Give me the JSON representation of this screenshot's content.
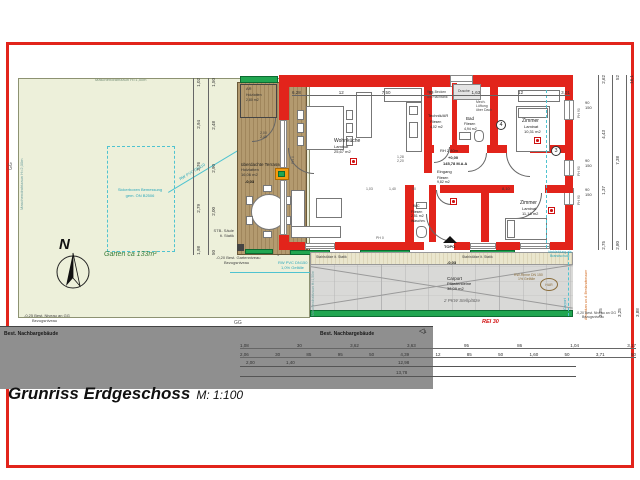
{
  "title": {
    "main": "Grunriss Erdgeschoss",
    "scale": "M: 1:100"
  },
  "compass": {
    "n": "N"
  },
  "garden": {
    "label": "Garten ca 133m²",
    "fence_top": "Maschendrahtzaun H=1,50m",
    "fence_left": "Maschendrahtzaun H=2,00m",
    "gg_left": "GG",
    "gg_bottom": "GG",
    "level1": "-0,25 Best. Niveau an GG",
    "level2": "Bezugsniveau",
    "sicker1": "Sickerboxen Bemessung",
    "sicker2": "gem. ÖN B2506",
    "glevel1": "-0,20 Best. Gartenniveau",
    "glevel2": "Bezugsniveau",
    "shading": "Verschattungselemente",
    "pipe_diag": "RW PVC DN110",
    "pipe1": "RW PVC DN150",
    "pipe2": "1,0% Gefälle"
  },
  "terrace": {
    "name": "überdachte Terrasse",
    "finish": "Holzlatten",
    "area": "16,06 m2",
    "level": "-0,03",
    "stb1": "STB- Säule",
    "stb2": "lt. Statik",
    "door_w": "2,00",
    "door_h": "2,40"
  },
  "ar": {
    "name": "AR",
    "finish": "Holzlatten",
    "area": "2,80 m2"
  },
  "rooms": {
    "wohnkueche": {
      "name": "Wohnküche",
      "finish": "Laminat",
      "area": "25,67 m2"
    },
    "technik": {
      "name": "Technik/AR",
      "finish": "Fliesen",
      "area": "4,02 m2"
    },
    "bad": {
      "name": "Bad",
      "finish": "Fliesen",
      "area": "4,94 m2"
    },
    "zimmer1": {
      "name": "Zimmer",
      "finish": "Laminat",
      "area": "10,31 m2"
    },
    "eingang": {
      "name": "Eingang",
      "finish": "Fliesen",
      "area": "9,82 m2",
      "rh": "RH 2,80m",
      "level": "+0,00",
      "alt": "145,78 M.ü.A"
    },
    "wc": {
      "name": "WC",
      "finish": "Fliesen",
      "area": "2,51 m2"
    },
    "zimmer2": {
      "name": "Zimmer",
      "finish": "Laminat",
      "area": "11,18 m2"
    }
  },
  "notes": {
    "tech1": "Ret.-Becken",
    "tech2": "als Flachtank",
    "dusche": "Dusche",
    "bad1": "Mech.",
    "bad2": "Lüftung",
    "bad3": "über Dach",
    "waschm": "Waschm."
  },
  "tags": {
    "win90": "90",
    "win150": "150",
    "ph90": "PH 90",
    "ph0": "PH 0",
    "w128": "1,28",
    "w220": "2,20",
    "d810": "8,10",
    "edims": [
      "1,03",
      "1,40",
      "50"
    ]
  },
  "markers": {
    "c4": "4",
    "c3": "3",
    "road": "1",
    "tri": "◁"
  },
  "carport": {
    "name": "Carport",
    "finish": "Pflastersteine",
    "area": "38,09 m2",
    "spaces": "2 PKW Stellplätze",
    "level": "-0,03",
    "topo": "TOPO",
    "gutter1": "RW-Rinne DN 150",
    "gutter2": "1% Gefälle",
    "har": "HAR",
    "rei": "REI 30",
    "col": "Stahlstütze lt. Statik",
    "fence": "Maschendrahtzaun H=1,50m",
    "cyan1": "Verkleidung als",
    "cyan2": "Brandschutz",
    "side": "Carport",
    "orange": "Anschluss an d. Bestandsmauer",
    "olevel1": "-0,20 Best. Niveau an GG",
    "olevel2": "Bezugsniveau"
  },
  "road": {
    "label": "Best. Nachbargebäude"
  },
  "dims": {
    "top": [
      "6,28",
      "12",
      "7,50",
      "92",
      "1,63",
      "12",
      "3,01"
    ],
    "left_a": [
      "1,02",
      "2,94",
      "3,76",
      "2,79",
      "1,98"
    ],
    "left_b": [
      "1,50",
      "2,48",
      "2,90",
      "2,00",
      "50"
    ],
    "right_a": [
      "2,62",
      "4,43",
      "1,37",
      "2,75"
    ],
    "right_b": [
      "52",
      "7,38",
      "2,80"
    ],
    "right_c": [
      "16,1"
    ],
    "cp": [
      "3,25",
      "3,25",
      "3,88"
    ],
    "bot_a": [
      "1,08",
      "30",
      "3,62",
      "3,63",
      "95",
      "86",
      "1,04",
      "3,17"
    ],
    "bot_b": [
      "2,06",
      "30",
      "85",
      "95",
      "50",
      "4,39",
      "12",
      "85",
      "50",
      "1,60",
      "50",
      "3,71",
      "50"
    ],
    "bot_c": [
      "2,00",
      "1,40",
      "12,98"
    ],
    "bot_d": "13,78"
  },
  "colors": {
    "wall_red": "#e2241b",
    "green": "#21a651",
    "wood": "#ac9369",
    "garden": "#edf0da",
    "carport_gray": "#d9d9d7",
    "road_gray": "#8f8f8f",
    "cyan": "#2ba8bc",
    "orange": "#f39c12"
  }
}
